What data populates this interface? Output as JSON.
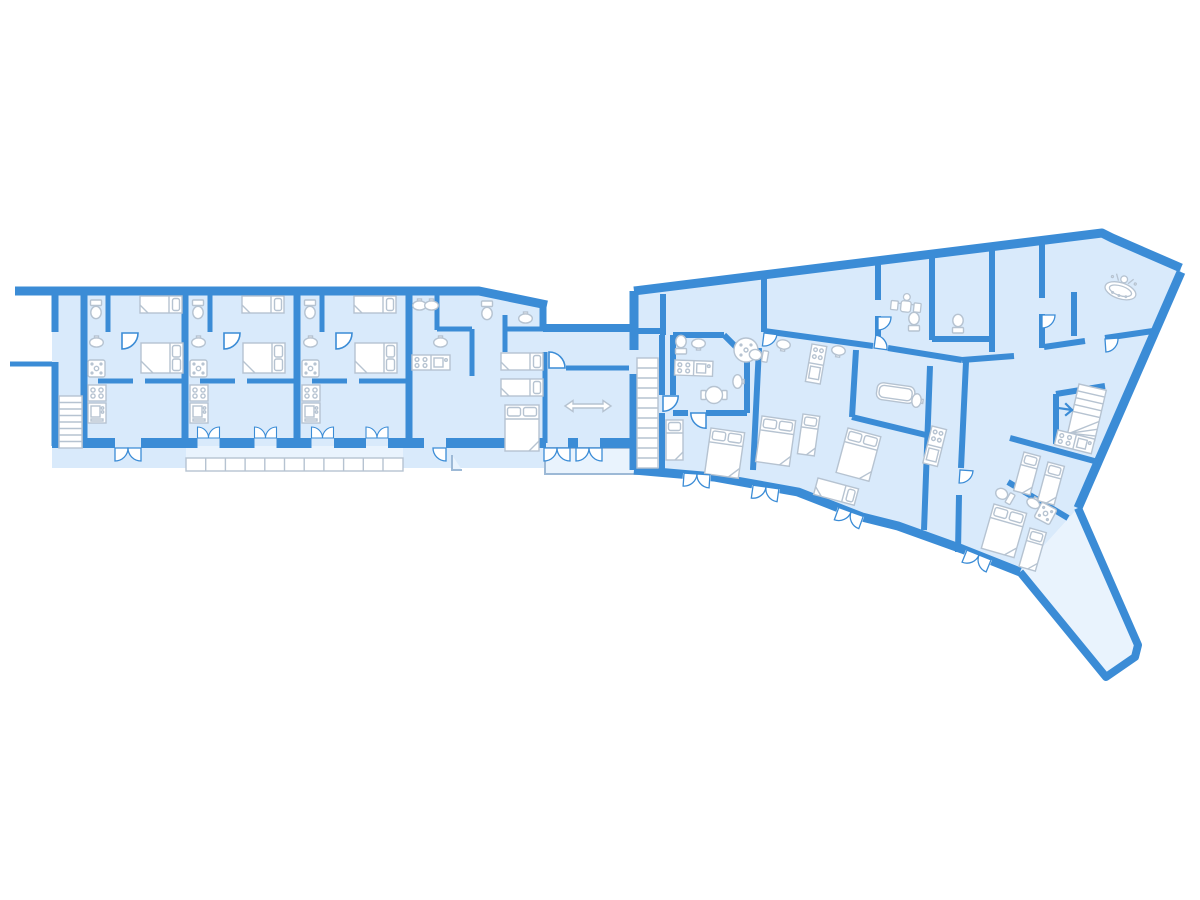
{
  "document": {
    "title": "Residential floor plan",
    "style": "blue architectural line plan on white background",
    "visible_text": "none"
  },
  "colors": {
    "background": "#ffffff",
    "wall": "#3b8cd6",
    "room_fill": "#d9eafb",
    "outdoor_fill": "#e9f3fd",
    "furniture_stroke": "#b6c3d1",
    "furniture_fill": "#ffffff",
    "railing_stroke": "#9db9d6",
    "arrow": "#ffffff"
  },
  "floorplan": {
    "left_wing": {
      "description": "straight horizontal wing with four repeated apartment units",
      "features": [
        "entry-courtyard",
        "exterior-staircase",
        "garden-wall-stub",
        "terrace",
        "terrace-railing",
        "building-notch"
      ],
      "apartments": [
        {
          "id": "apartment-1",
          "rooms": [
            "bathroom",
            "bedroom",
            "kitchen-living"
          ],
          "furniture": [
            "toilet",
            "washbasin",
            "shower",
            "stove",
            "kitchen-sink",
            "single-bed",
            "double-bed",
            "interior-door",
            "garden-double-door"
          ]
        },
        {
          "id": "apartment-2",
          "rooms": [
            "bathroom",
            "bedroom",
            "kitchen-living"
          ],
          "furniture": [
            "toilet",
            "washbasin",
            "shower",
            "stove",
            "kitchen-sink",
            "single-bed",
            "double-bed",
            "interior-door",
            "terrace-double-door",
            "terrace-double-door"
          ]
        },
        {
          "id": "apartment-3",
          "rooms": [
            "bathroom",
            "bedroom",
            "kitchen-living"
          ],
          "furniture": [
            "toilet",
            "washbasin",
            "shower",
            "stove",
            "kitchen-sink",
            "single-bed",
            "double-bed",
            "interior-door",
            "terrace-double-door",
            "terrace-double-door"
          ]
        },
        {
          "id": "apartment-4",
          "rooms": [
            "bathroom",
            "wc",
            "kitchen",
            "bedroom",
            "hall-with-span-arrow"
          ],
          "furniture": [
            "washbasin",
            "washbasin",
            "toilet",
            "washbasin",
            "stove",
            "kitchen-sink",
            "single-bed",
            "single-bed",
            "double-bed",
            "span-arrow",
            "terrace-double-door",
            "terrace-double-door",
            "garden-door"
          ]
        }
      ]
    },
    "right_wing": {
      "description": "fanned wing rotated roughly 7-20 degrees clockwise ending in a service tail corridor",
      "features": [
        "entry-corridor",
        "long-staircase",
        "winder-staircase",
        "stair-direction-arrow",
        "dining-area",
        "spa-room",
        "tail-corridor"
      ],
      "units": [
        {
          "id": "unit-a",
          "furniture": [
            "toilet",
            "washbasin",
            "kitchen-counter",
            "round-table",
            "round-shower",
            "washbasin",
            "single-bed",
            "double-bed"
          ]
        },
        {
          "id": "unit-b",
          "furniture": [
            "toilet",
            "washbasin",
            "washbasin",
            "kitchen-block",
            "bathtub",
            "washbasin",
            "washbasin",
            "double-bed",
            "single-bed",
            "double-bed",
            "single-bed"
          ]
        },
        {
          "id": "unit-c",
          "furniture": [
            "kitchen-block",
            "toilet",
            "toilet"
          ]
        },
        {
          "id": "unit-d",
          "furniture": [
            "kitchen-counter",
            "single-bed",
            "single-bed",
            "toilet",
            "washbasin",
            "shower"
          ]
        },
        {
          "id": "unit-e",
          "furniture": [
            "double-bed",
            "single-bed"
          ]
        }
      ]
    }
  },
  "icons": {
    "door": "quarter-circle door swing",
    "staircase": "tread lines on white run",
    "span-arrow": "white double-headed arrow",
    "stair-arrow": "small blue direction arrow",
    "dining-area-icon": "person seated at table, top view",
    "spa-icon": "person in tub, top view"
  }
}
